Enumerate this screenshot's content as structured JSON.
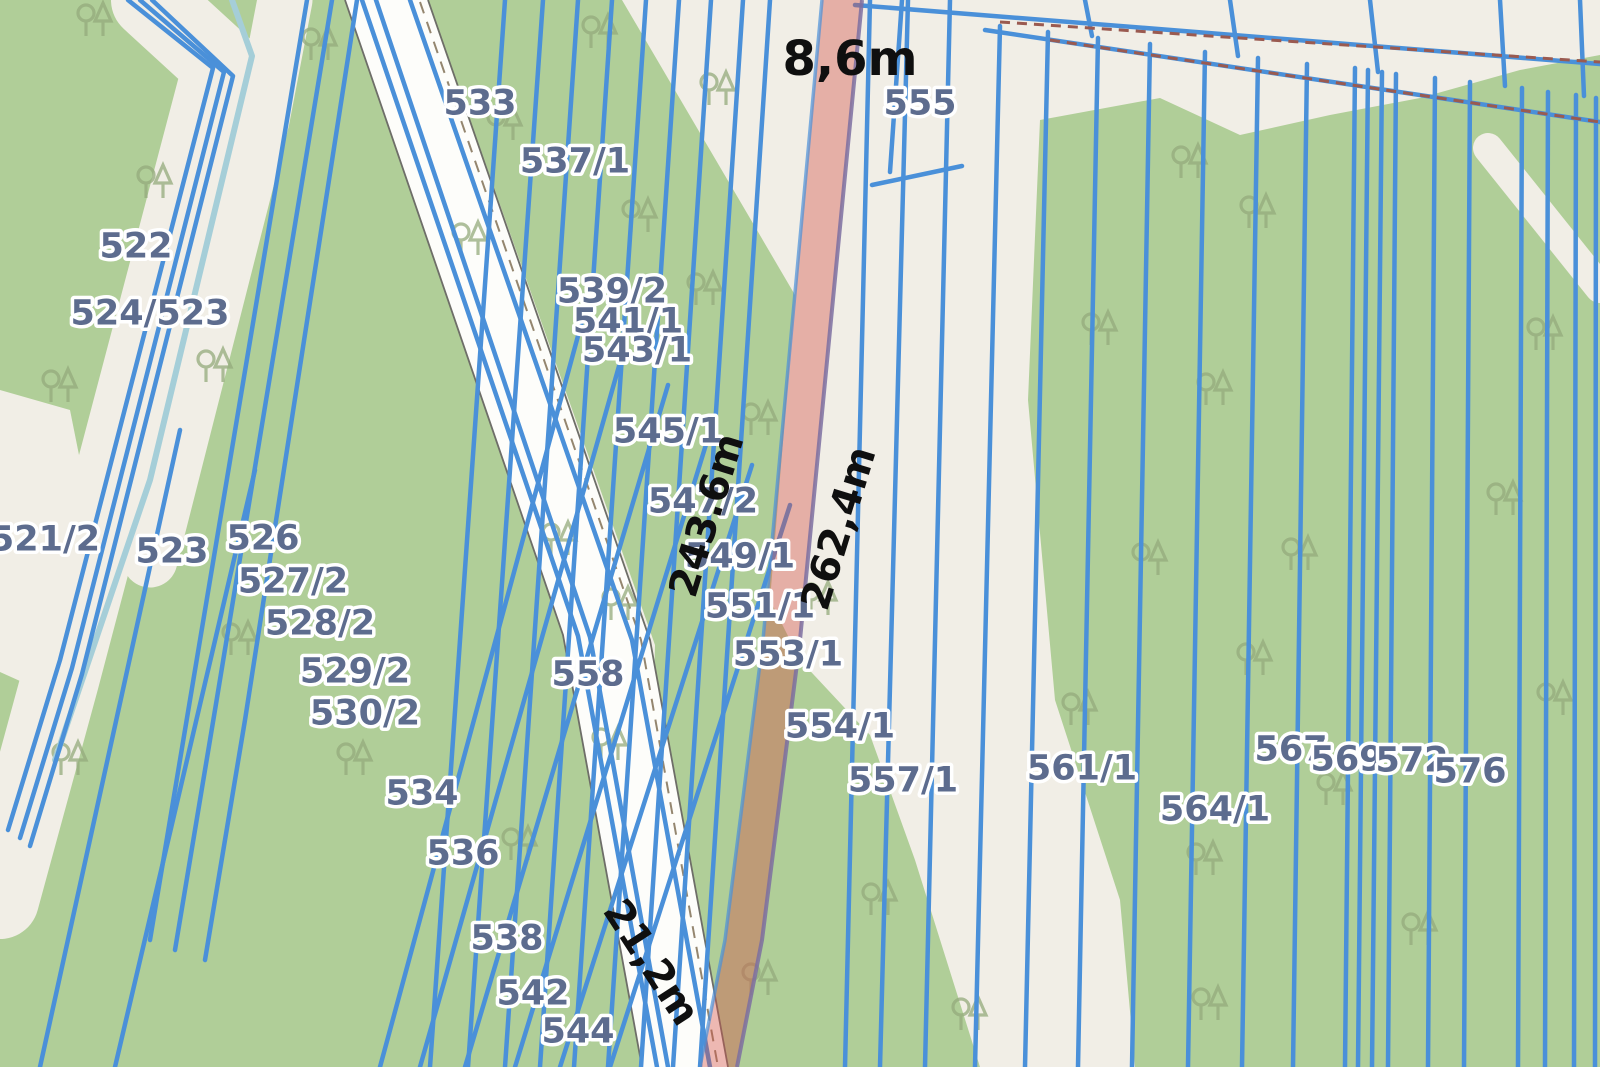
{
  "map": {
    "type": "cadastral-parcel-map",
    "colors": {
      "forest_green": "#b0ce98",
      "background_beige": "#f1eee6",
      "boundary_blue": "#4a90d9",
      "road_white": "#fdfdfa",
      "water_teal": "#a5ced8",
      "highlight_red": "#d55046",
      "highlight_edge_purple": "#7c6fa0",
      "dashed_red": "#9a5a50",
      "label_blue_gray": "#5d6c8e",
      "measurement_black": "#0f0f0f",
      "tree_gray_green": "#94ab7c"
    },
    "parcels": [
      {
        "label": "522"
      },
      {
        "label": "524/523"
      },
      {
        "label": "521/2"
      },
      {
        "label": "523"
      },
      {
        "label": "526"
      },
      {
        "label": "527/2"
      },
      {
        "label": "528/2"
      },
      {
        "label": "529/2"
      },
      {
        "label": "530/2"
      },
      {
        "label": "533"
      },
      {
        "label": "534"
      },
      {
        "label": "536"
      },
      {
        "label": "537/1"
      },
      {
        "label": "538"
      },
      {
        "label": "539/2"
      },
      {
        "label": "541/1"
      },
      {
        "label": "542"
      },
      {
        "label": "543/1"
      },
      {
        "label": "544"
      },
      {
        "label": "545/1"
      },
      {
        "label": "547/2"
      },
      {
        "label": "549/1"
      },
      {
        "label": "551/1"
      },
      {
        "label": "553/1"
      },
      {
        "label": "554/1"
      },
      {
        "label": "555"
      },
      {
        "label": "557/1"
      },
      {
        "label": "558"
      },
      {
        "label": "561/1"
      },
      {
        "label": "564/1"
      },
      {
        "label": "567"
      },
      {
        "label": "569"
      },
      {
        "label": "572"
      },
      {
        "label": "576"
      }
    ],
    "measurements": [
      {
        "label": "8,6m"
      },
      {
        "label": "243.6m"
      },
      {
        "label": "262,4m"
      },
      {
        "label": "21,2m"
      }
    ]
  }
}
